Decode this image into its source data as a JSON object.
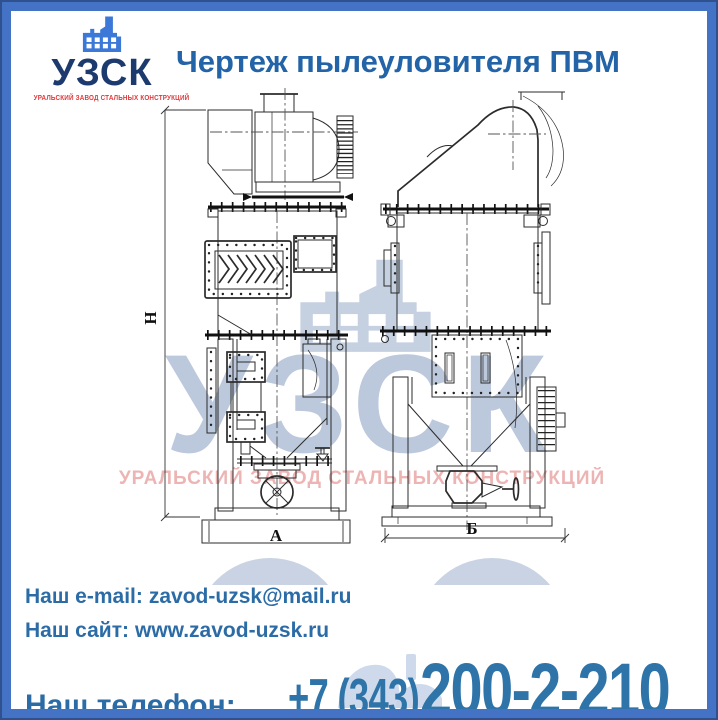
{
  "colors": {
    "border": "#4472c4",
    "border_outline": "#2f528f",
    "title": "#2264a7",
    "logo_name": "#1c3a6e",
    "logo_icon": "#3b78d8",
    "logo_subtitle": "#e0393c",
    "contact_text": "#2c6ca6",
    "phone_text": "#2e74a8",
    "drawing_line": "#2b2b2b",
    "watermark_blue": "#bcc8dc",
    "watermark_red": "#e89b9b"
  },
  "logo": {
    "name": "УЗСК",
    "subtitle": "УРАЛЬСКИЙ ЗАВОД СТАЛЬНЫХ КОНСТРУКЦИЙ"
  },
  "header": {
    "title": "Чертеж пылеуловителя ПВМ"
  },
  "drawing": {
    "views": [
      {
        "id": "front",
        "width_label": "А"
      },
      {
        "id": "side",
        "width_label": "Б"
      }
    ],
    "labels": {
      "height": "Н",
      "front_width": "А",
      "side_width": "Б"
    },
    "watermark": {
      "text": "УЗСК",
      "subtext": "УРАЛЬСКИЙ ЗАВОД СТАЛЬНЫХ КОНСТРУКЦИЙ"
    }
  },
  "contacts": {
    "email_label": "Наш e-mail:",
    "email": "zavod-uzsk@mail.ru",
    "site_label": "Наш сайт:",
    "site": "www.zavod-uzsk.ru",
    "phone_label": "Наш телефон:",
    "phone_code": "+7 (343)",
    "phone_number": "200-2-210"
  }
}
